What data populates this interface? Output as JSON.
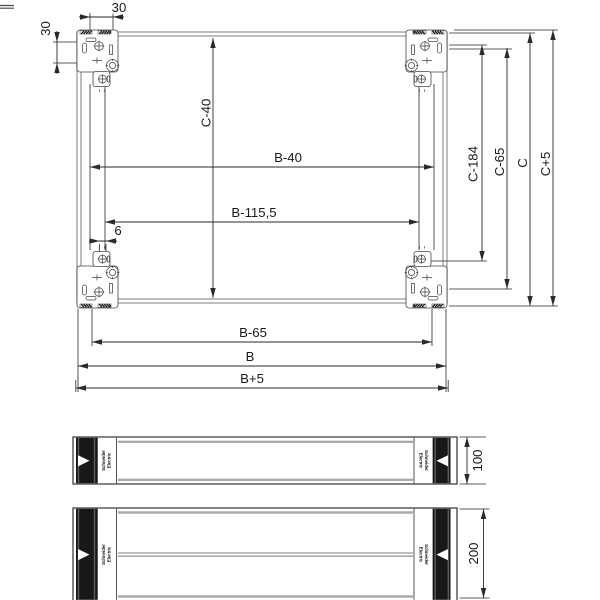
{
  "drawing": {
    "colors": {
      "line": "#2a2a2a",
      "frame": "#a2a2a2",
      "panel_black": "#181818"
    },
    "top_view_dims": {
      "offset_top": "30",
      "offset_left": "30",
      "six": "6",
      "c40": "C-40",
      "b40": "B-40",
      "b1155": "B-115,5",
      "c184": "C-184",
      "c65": "C-65",
      "c": "C",
      "c_plus5": "C+5",
      "b65": "B-65",
      "b": "B",
      "b_plus5": "B+5"
    },
    "side_views": {
      "height_small": "100",
      "height_large": "200",
      "brand_line1": "Schneider",
      "brand_line2": "Electric"
    }
  }
}
